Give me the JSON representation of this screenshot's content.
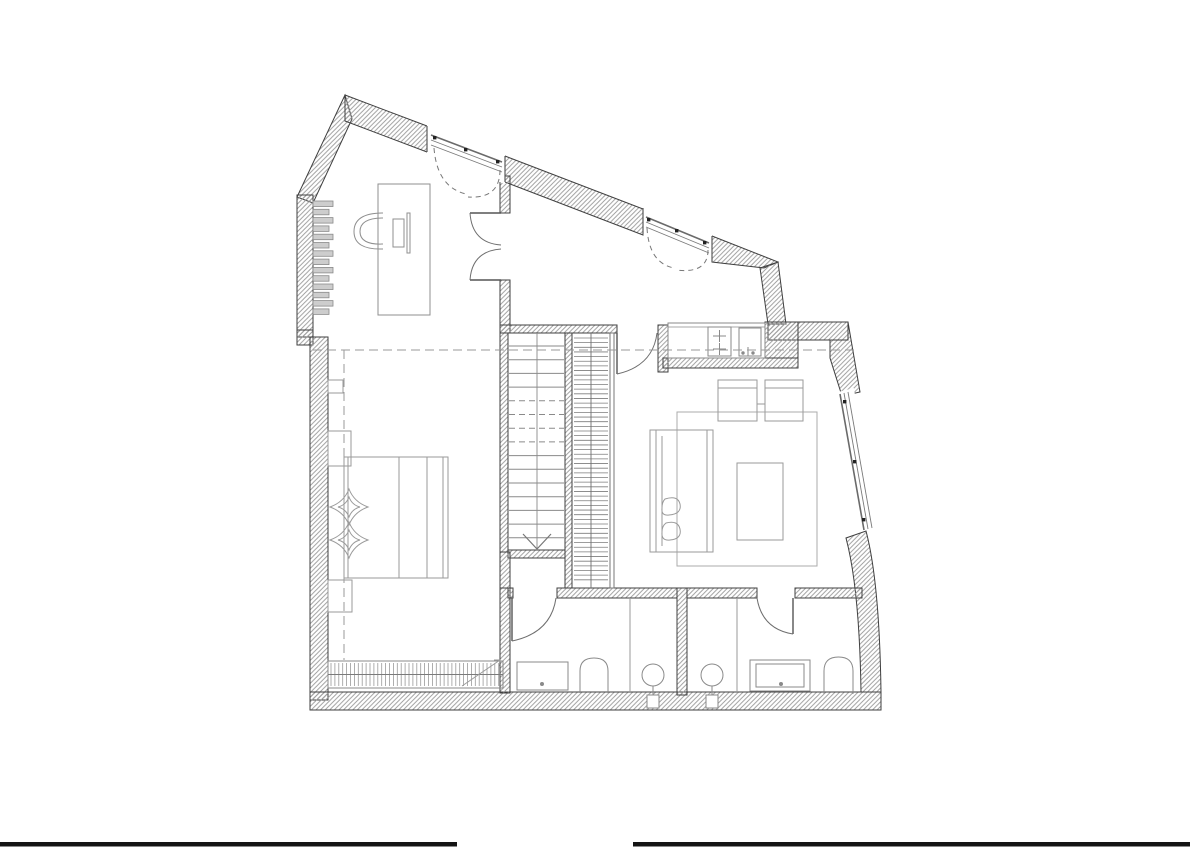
{
  "drawing": {
    "kind": "architectural-floor-plan",
    "floor": "upper-attic-level",
    "visible_text": ""
  },
  "palette": {
    "background": "#ffffff",
    "wall_outline": "#3f3f3f",
    "hatch": "#9c9c9c",
    "thin_line": "#8f8f8f",
    "furniture": "#9a9a9a",
    "stair_tread": "#8a8a8a",
    "door_arc": "#6e6e6e",
    "dashed_section": "#9a9a9a",
    "fixture": "#8a8a8a",
    "radiator_fill": "#cdcdcd",
    "footer_bar": "#141414"
  },
  "stairs": {
    "left_flight": {
      "x1": 509,
      "x2": 564,
      "y0": 346,
      "dy": 13.7,
      "count": 15,
      "dash_from": 398,
      "dash_to": 452,
      "rail_x": 537
    },
    "right_flight": {
      "x1": 574,
      "x2": 608,
      "y0": 338,
      "dy": 4.65,
      "count": 53,
      "rail_x": 591
    },
    "arrow": {
      "x1": 523,
      "x2": 551,
      "tip_x": 537,
      "y_top": 534,
      "y_tip": 549
    }
  },
  "radiators": {
    "office": {
      "x": 313,
      "y0": 201,
      "pitch": 8.3,
      "count": 14,
      "w_even": 20,
      "w_odd": 16,
      "h": 5.5
    },
    "bedroom": {
      "x0": 331,
      "x1": 500,
      "step": 3.9,
      "y1": 663,
      "y2": 686,
      "mid_y": 674.5
    }
  },
  "legend": {
    "symbols": [
      "hatched-masonry-wall",
      "french-window",
      "door-swing-arc",
      "stair-flight-down",
      "stair-flight-up",
      "bed-with-pillows",
      "nightstand",
      "desk",
      "office-chair",
      "monitor",
      "keyboard",
      "wardrobe-radiator",
      "convector-radiator",
      "kitchen-counter",
      "double-sink",
      "water-heater",
      "sofa",
      "coffee-table",
      "armchair",
      "rug",
      "washbasin",
      "toilet",
      "shower-drain",
      "ceiling-height-dashed-line"
    ]
  },
  "footer_bars": {
    "left": {
      "x": 0,
      "w": 457
    },
    "right": {
      "x": 633,
      "w": 557
    },
    "y": 842,
    "h": 4.5
  }
}
